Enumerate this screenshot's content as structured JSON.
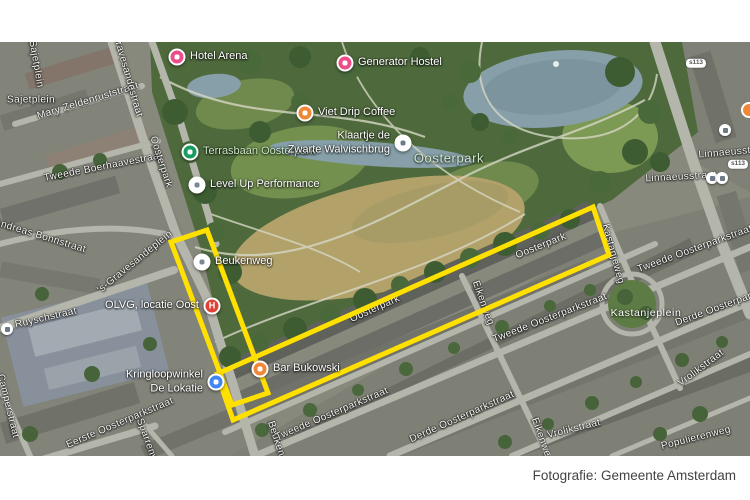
{
  "caption": {
    "text": "Fotografie: Gemeente Amsterdam"
  },
  "map": {
    "highlight": {
      "color": "#ffe000",
      "stroke_width": 5,
      "polygons": [
        {
          "name": "beukenweg-block",
          "points": [
            [
              171,
              200
            ],
            [
              207,
              188
            ],
            [
              268,
              351
            ],
            [
              232,
              363
            ]
          ]
        },
        {
          "name": "oosterpark-strip",
          "points": [
            [
              217,
              332
            ],
            [
              593,
              165
            ],
            [
              609,
              213
            ],
            [
              233,
              378
            ]
          ]
        }
      ]
    },
    "pois": [
      {
        "name": "hotel-arena",
        "label": "Hotel Arena",
        "color": "#ec4d89",
        "x": 177,
        "y": 15,
        "side": "right"
      },
      {
        "name": "generator-hostel",
        "label": "Generator Hostel",
        "color": "#ec4d89",
        "x": 345,
        "y": 21,
        "side": "right"
      },
      {
        "name": "viet-drip-coffee",
        "label": "Viet Drip Coffee",
        "color": "#ef8836",
        "x": 305,
        "y": 71,
        "side": "right"
      },
      {
        "name": "terrasbaan-oosterpark",
        "label": "Terrasbaan Oosterpark",
        "color": "#169c5f",
        "x": 190,
        "y": 110,
        "side": "right",
        "label_color": "#c8e6c3"
      },
      {
        "name": "level-up-performance",
        "label": "Level Up Performance",
        "color": "#ffffff",
        "glyph": "#7a8795",
        "x": 197,
        "y": 143,
        "side": "right"
      },
      {
        "name": "klaartje-de-zwarte-walvischbrug",
        "label": "Klaartje de",
        "label2": "Zwarte Walvischbrug",
        "color": "#ffffff",
        "glyph": "#6b7c8a",
        "x": 403,
        "y": 101,
        "side": "left"
      },
      {
        "name": "beukenweg-stop",
        "label": "Beukenweg",
        "color": "#ffffff",
        "glyph": "#7a8795",
        "x": 202,
        "y": 220,
        "side": "right"
      },
      {
        "name": "olvg-locatie-oost",
        "label": "OLVG, locatie Oost",
        "color": "#e04235",
        "letter": "H",
        "x": 212,
        "y": 264,
        "side": "left"
      },
      {
        "name": "bar-bukowski",
        "label": "Bar Bukowski",
        "color": "#ef8836",
        "x": 260,
        "y": 327,
        "side": "right"
      },
      {
        "name": "kringloopwinkel-de-lokatie",
        "label": "Kringloopwinkel",
        "label2": "De Lokatie",
        "color": "#4285f4",
        "x": 216,
        "y": 340,
        "side": "left"
      }
    ],
    "street_labels": [
      {
        "text": "Sajetplein",
        "x": 36,
        "y": 22,
        "angle": 80
      },
      {
        "text": "Sajetplein",
        "x": 31,
        "y": 58,
        "angle": 0
      },
      {
        "text": "Mary Zeldenruststraat",
        "x": 88,
        "y": 59,
        "angle": -17
      },
      {
        "text": "'s-Gravesandestraat",
        "x": 126,
        "y": 28,
        "angle": 74
      },
      {
        "text": "Tweede Boerhaavestraat",
        "x": 103,
        "y": 125,
        "angle": -11
      },
      {
        "text": "Oosterpark",
        "x": 161,
        "y": 120,
        "angle": 72
      },
      {
        "text": "Andreas Bonnstraat",
        "x": 40,
        "y": 194,
        "angle": 17
      },
      {
        "text": "'s-Gravesandeplein",
        "x": 135,
        "y": 220,
        "angle": -39
      },
      {
        "text": "Ruyschstraat",
        "x": 46,
        "y": 276,
        "angle": -13
      },
      {
        "text": "Camperstraat",
        "x": 8,
        "y": 364,
        "angle": 76
      },
      {
        "text": "Eerste Oosterparkstraat",
        "x": 120,
        "y": 381,
        "angle": -23
      },
      {
        "text": "Sparrenweg",
        "x": 149,
        "y": 404,
        "angle": 70
      },
      {
        "text": "Beukenweg",
        "x": 279,
        "y": 406,
        "angle": 72
      },
      {
        "text": "Tweede Oosterparkstraat",
        "x": 332,
        "y": 372,
        "angle": -23
      },
      {
        "text": "Derde Oosterparkstraat",
        "x": 462,
        "y": 375,
        "angle": -24
      },
      {
        "text": "Oosterpark",
        "x": 375,
        "y": 267,
        "angle": -24
      },
      {
        "text": "Oosterpark",
        "x": 541,
        "y": 204,
        "angle": -22
      },
      {
        "text": "Eikenweg",
        "x": 483,
        "y": 261,
        "angle": 70
      },
      {
        "text": "Eikenweg",
        "x": 542,
        "y": 398,
        "angle": 70
      },
      {
        "text": "Tweede Oosterparkstraat",
        "x": 550,
        "y": 276,
        "angle": -21
      },
      {
        "text": "Tweede Oosterparkstraat",
        "x": 695,
        "y": 207,
        "angle": -20
      },
      {
        "text": "Derde Oosterparkstraat",
        "x": 729,
        "y": 262,
        "angle": -20
      },
      {
        "text": "Kastanjeweg",
        "x": 613,
        "y": 212,
        "angle": 75
      },
      {
        "text": "Vrolikstraat",
        "x": 701,
        "y": 326,
        "angle": -37
      },
      {
        "text": "Vrolikstraat",
        "x": 574,
        "y": 387,
        "angle": -14
      },
      {
        "text": "Populierenweg",
        "x": 696,
        "y": 396,
        "angle": -14
      },
      {
        "text": "Linnaeusstraat",
        "x": 681,
        "y": 135,
        "angle": -3
      },
      {
        "text": "Linnaeusstraat",
        "x": 734,
        "y": 110,
        "angle": -5
      }
    ],
    "area_labels": [
      {
        "text": "Oosterpark",
        "x": 449,
        "y": 116,
        "color": "#cfe9c8",
        "size": 13
      },
      {
        "text": "Kastanjeplein",
        "x": 646,
        "y": 271,
        "color": "#ffffff",
        "size": 10.5
      }
    ],
    "route_shields": [
      {
        "text": "s113",
        "x": 696,
        "y": 21
      },
      {
        "text": "s113",
        "x": 738,
        "y": 122
      }
    ],
    "transit_icons": [
      {
        "x": 7,
        "y": 287
      },
      {
        "x": 725,
        "y": 88
      },
      {
        "x": 712,
        "y": 136
      },
      {
        "x": 722,
        "y": 136
      }
    ]
  }
}
